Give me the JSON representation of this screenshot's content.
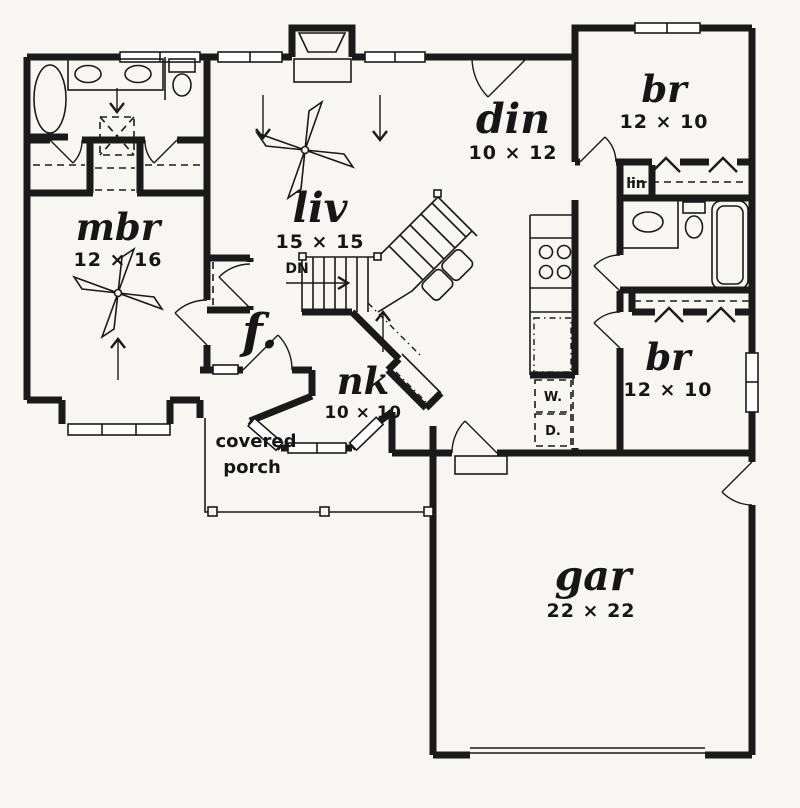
{
  "plan": {
    "colors": {
      "ink": "#1a1a1a",
      "paper": "#f7f6f2"
    },
    "rooms": {
      "master_bedroom": {
        "name": "mbr",
        "dims": "12 × 16"
      },
      "living": {
        "name": "liv",
        "dims": "15 × 15"
      },
      "dining": {
        "name": "din",
        "dims": "10 × 12"
      },
      "bedroom_top": {
        "name": "br",
        "dims": "12 × 10"
      },
      "bedroom_right": {
        "name": "br",
        "dims": "12 × 10"
      },
      "nook": {
        "name": "nk",
        "dims": "10 × 10"
      },
      "garage": {
        "name": "gar",
        "dims": "22 × 22"
      },
      "foyer": {
        "name": "f."
      },
      "porch": {
        "line1": "covered",
        "line2": "porch"
      }
    },
    "labels": {
      "stairs_down": "DN",
      "linen": "lin",
      "washer": "W.",
      "dryer": "D."
    }
  }
}
